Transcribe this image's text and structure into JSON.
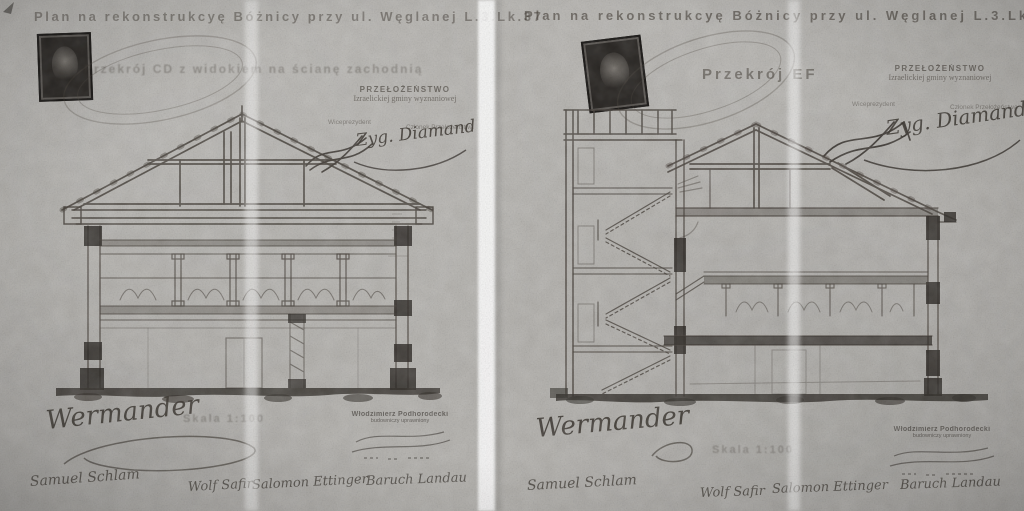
{
  "photo": {
    "paper_color": "#b4b2ae",
    "ink_color": "#3b352e"
  },
  "left": {
    "title": "Plan na rekonstrukcyę Bóżnicy przy ul. Węglanej L.3.Lk.37",
    "section_label": "Przekrój CD z widokiem na ścianę zachodnią",
    "authority_line1": "PRZEŁOŻEŃSTWO",
    "authority_line2": "Izraelickiej gminy wyznaniowej",
    "role_left": "Wiceprezydent",
    "role_right": "Członek Przełożeństwa",
    "committee_signature": "Zyg. Diamand",
    "architect_signature": "Wermander",
    "scale_label": "Skala 1:100",
    "stamp_name": "Włodzimierz Podhorodecki",
    "stamp_line2": "budowniczy uprawniony",
    "signatures": [
      "Samuel Schlam",
      "Wolf Safir",
      "Salomon Ettinger",
      "Baruch Landau"
    ]
  },
  "right": {
    "title": "Plan na rekonstrukcyę Bóżnicy przy ul. Węglanej L.3.Lk.37",
    "section_label": "Przekrój EF",
    "authority_line1": "PRZEŁOŻEŃSTWO",
    "authority_line2": "Izraelickiej gminy wyznaniowej",
    "role_left": "Wiceprezydent",
    "role_right": "Członek Przełożeństwa",
    "committee_signature": "Zyg. Diamand",
    "architect_signature": "Wermander",
    "scale_label": "Skala 1:100",
    "stamp_name": "Włodzimierz Podhorodecki",
    "stamp_line2": "budowniczy uprawniony",
    "signatures": [
      "Samuel Schlam",
      "Wolf Safir",
      "Salomon Ettinger",
      "Baruch Landau"
    ]
  }
}
